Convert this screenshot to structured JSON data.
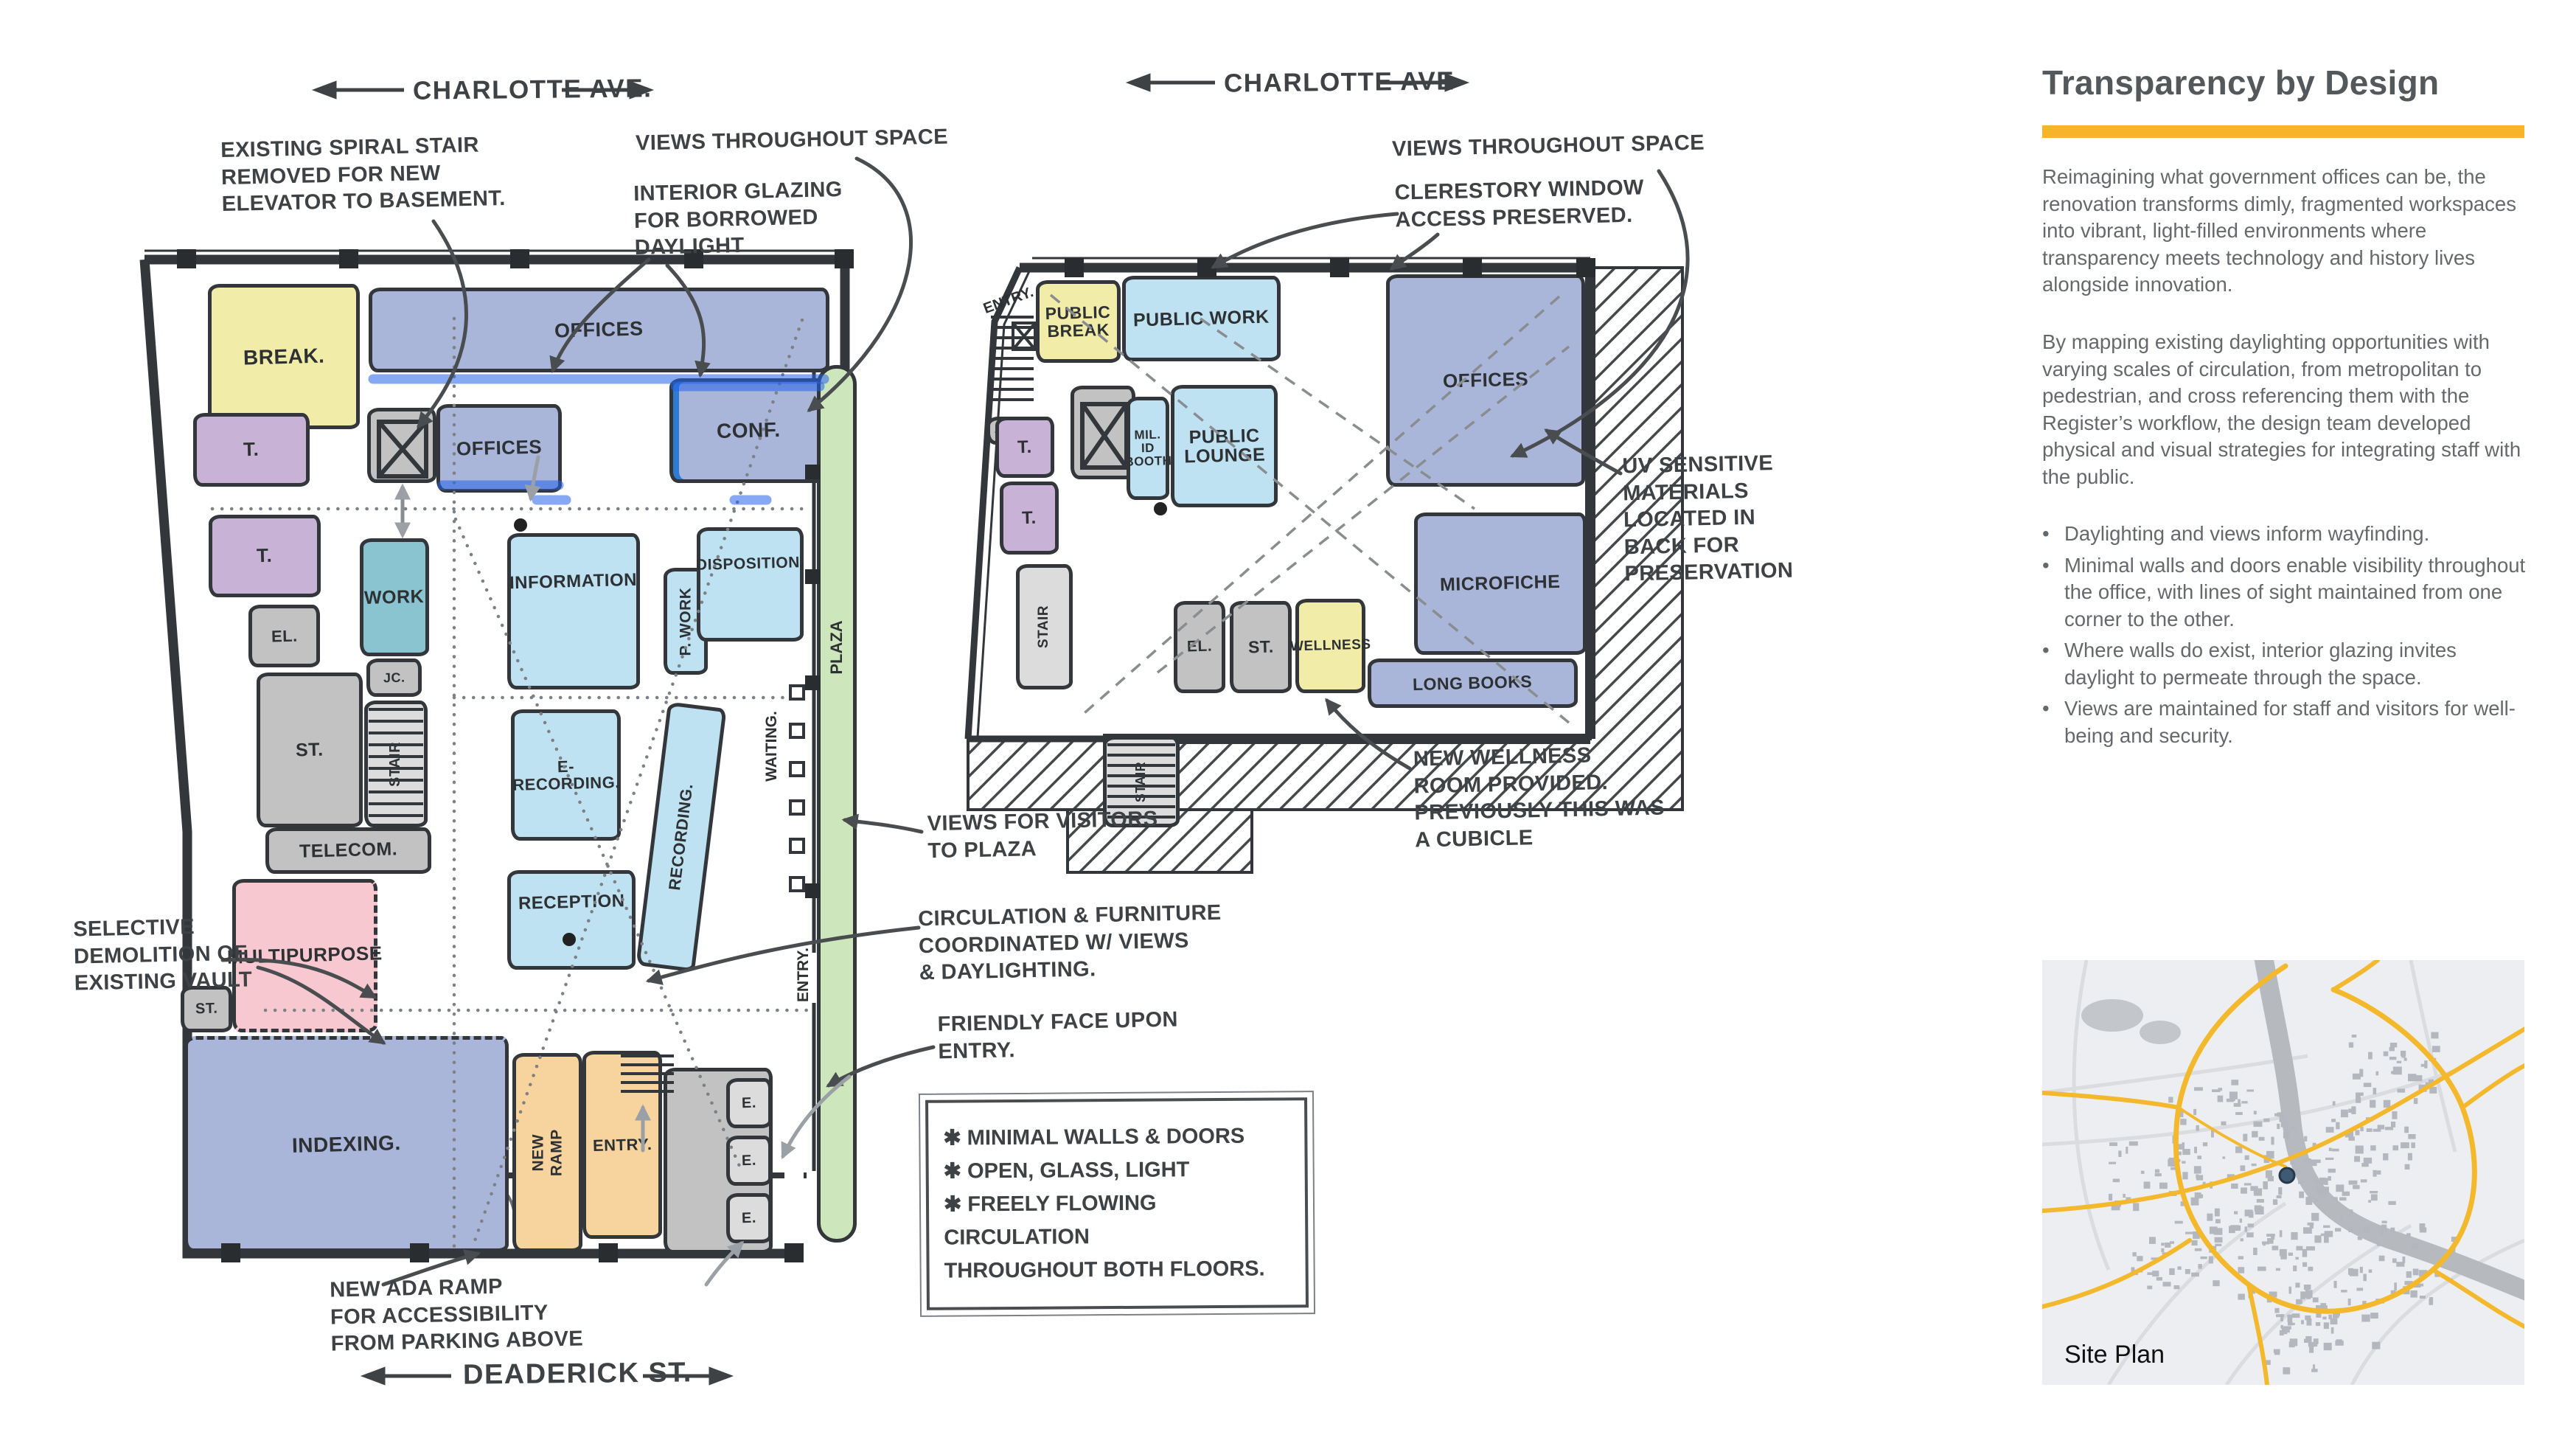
{
  "left_plan": {
    "street_top": "CHARLOTTE AVE.",
    "street_bottom": "DEADERICK ST.",
    "rooms": {
      "break": "BREAK.",
      "offices_top": "OFFICES",
      "t1": "T.",
      "t2": "T.",
      "el": "EL.",
      "offices_mid": "OFFICES",
      "conf": "CONF.",
      "work": "WORK",
      "jc": "JC.",
      "st_big": "ST.",
      "stair": "STAIR",
      "telecom": "TELECOM.",
      "information": "INFORMATION",
      "p_work": "P. WORK",
      "disposition": "DISPOSITION.",
      "e_recording": "E-RECORDING.",
      "recording": "RECORDING.",
      "reception": "RECEPTION",
      "waiting": "WAITING.",
      "plaza": "PLAZA",
      "multipurpose": "MULTIPURPOSE",
      "st_small": "ST.",
      "indexing": "INDEXING.",
      "new_ramp": "NEW\nRAMP",
      "entry": "ENTRY.",
      "e1": "E.",
      "e2": "E.",
      "e3": "E.",
      "entry_side": "ENTRY."
    },
    "annotations": {
      "spiral_stair": "EXISTING SPIRAL STAIR\nREMOVED FOR NEW\nELEVATOR TO BASEMENT.",
      "views": "VIEWS THROUGHOUT SPACE",
      "glazing": "INTERIOR GLAZING\nFOR BORROWED\nDAYLIGHT",
      "selective": "SELECTIVE\nDEMOLITION OF\nEXISTING VAULT",
      "views_plaza": "VIEWS FOR VISITORS\nTO PLAZA",
      "circulation": "CIRCULATION & FURNITURE\nCOORDINATED W/ VIEWS\n& DAYLIGHTING.",
      "friendly": "FRIENDLY FACE UPON\nENTRY.",
      "ada": "NEW ADA RAMP\nFOR ACCESSIBILITY\nFROM PARKING ABOVE",
      "key_box": [
        "✱ MINIMAL WALLS & DOORS",
        "✱ OPEN, GLASS, LIGHT",
        "✱ FREELY FLOWING CIRCULATION\n      THROUGHOUT BOTH FLOORS."
      ]
    }
  },
  "right_plan": {
    "street_top": "CHARLOTTE AVE",
    "rooms": {
      "entry": "ENTRY.",
      "public_break": "PUBLIC\nBREAK",
      "public_work": "PUBLIC WORK",
      "offices": "OFFICES",
      "jc": "J.C.",
      "t1": "T.",
      "t2": "T.",
      "mil_id": "MIL.\nID\nBOOTH",
      "public_lounge": "PUBLIC\nLOUNGE",
      "stair_west": "STAIR",
      "el": "EL.",
      "st": "ST.",
      "wellness": "WELLNESS",
      "microfiche": "MICROFICHE",
      "long_books": "LONG BOOKS",
      "stair_south": "STAIR"
    },
    "annotations": {
      "views": "VIEWS THROUGHOUT SPACE",
      "clerestory": "CLERESTORY WINDOW\nACCESS PRESERVED.",
      "uv": "UV SENSITIVE\nMATERIALS\nLOCATED IN\nBACK FOR\nPRESERVATION",
      "wellness_note": "NEW WELLNESS\nROOM PROVIDED.\nPREVIOUSLY THIS WAS\nA CUBICLE"
    }
  },
  "panel": {
    "title": "Transparency by Design",
    "accent_color": "#F6B42B",
    "paragraphs": [
      "Reimagining what government offices can be, the renovation transforms dimly, fragmented workspaces into vibrant, light-filled environments where transparency meets technology and history lives alongside innovation.",
      "By mapping existing daylighting opportunities with varying scales of circulation, from metropolitan to pedestrian, and cross referencing them with the Register’s workflow, the design team developed physical and visual strategies for integrating staff with the public."
    ],
    "bullet_glyph": "•",
    "bullets": [
      "Daylighting and views inform wayfinding.",
      "Minimal walls and doors enable visibility throughout the office, with lines of sight maintained from one corner to the other.",
      "Where walls do exist, interior glazing invites daylight to permeate through the space.",
      "Views are maintained for staff and visitors for well-being and security."
    ],
    "site_plan_label": "Site Plan"
  },
  "colors": {
    "ink": "#33363A",
    "accent": "#F6B42B",
    "office_blue": "#A9B6D9",
    "sky_blue": "#BFE2F2",
    "pale_yellow": "#F1EDA9",
    "lavender": "#C8B3D6",
    "teal": "#8AC4D0",
    "grey_room": "#C2C2C2",
    "pink": "#F7C8D0",
    "tan": "#F7D49E",
    "plaza_green": "#CDE6BC",
    "highlight_blue": "#2E7BD6",
    "map_bg": "#EDEEF1",
    "map_highway": "#F3B82C",
    "map_building": "#B7BAC0",
    "site_dot": "#3E5A74",
    "panel_text": "#66696C",
    "title_text": "#54585A"
  }
}
